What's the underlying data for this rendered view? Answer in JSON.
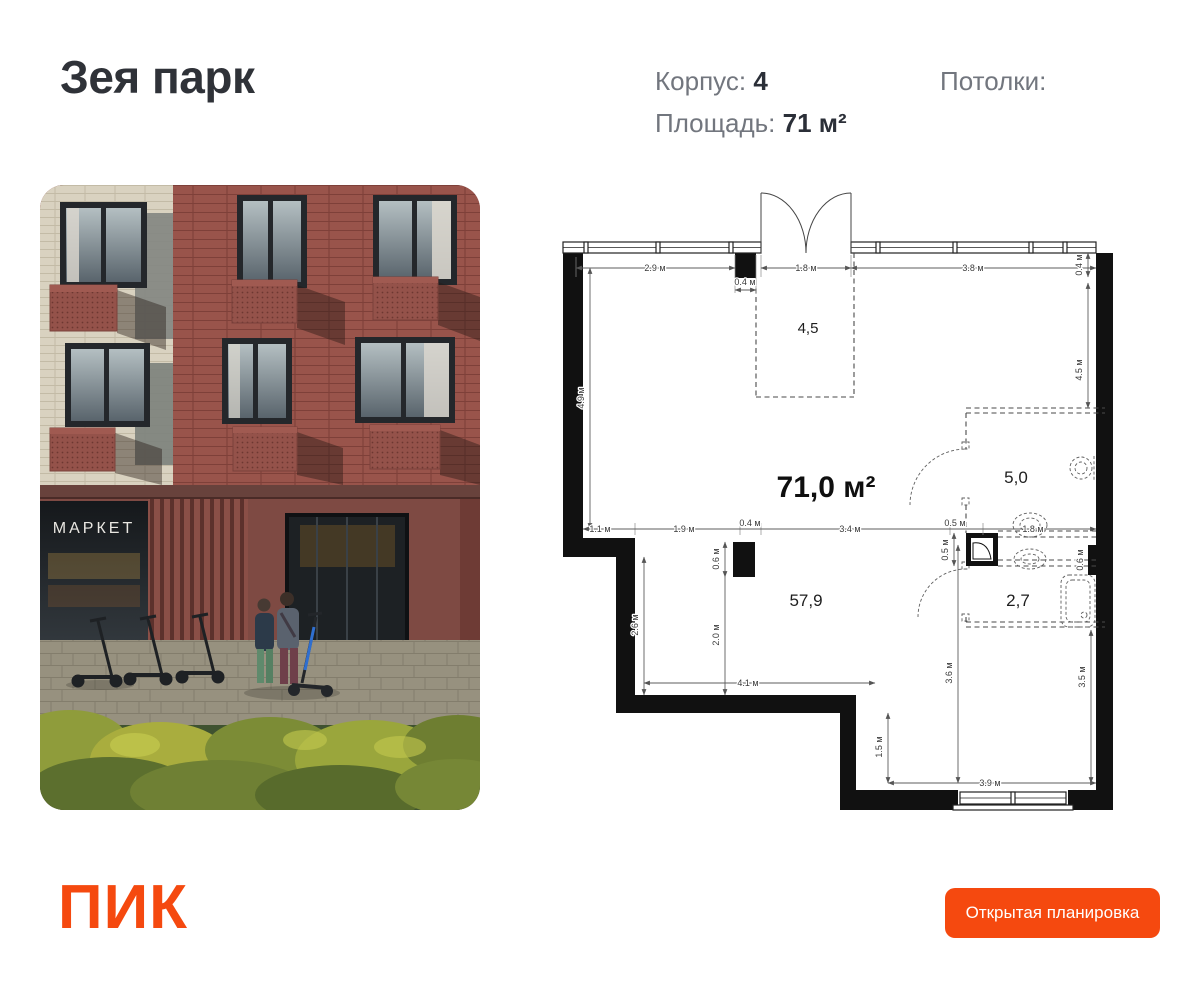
{
  "header": {
    "project_title": "Зея парк",
    "korpus": {
      "label": "Корпус:",
      "value": "4"
    },
    "area": {
      "label": "Площадь:",
      "value": "71 м²"
    },
    "ceilings": {
      "label": "Потолки:",
      "value": ""
    }
  },
  "photo": {
    "market_sign": "МАРКЕТ"
  },
  "plan": {
    "total_area": "71,0 м²",
    "rooms": [
      {
        "id": "terrace",
        "area": "4,5"
      },
      {
        "id": "living",
        "area": "57,9"
      },
      {
        "id": "wet-top",
        "area": "5,0"
      },
      {
        "id": "wet-bottom",
        "area": "2,7"
      }
    ],
    "dims": {
      "top_1": "2.9 м",
      "top_2": "0.4 м",
      "top_3": "1.8 м",
      "top_4": "3.8 м",
      "right_top": "0.4 м",
      "left_side": "4.9 м",
      "right_side": "4.5 м",
      "mid_1": "1.1 м",
      "mid_2": "1.9 м",
      "mid_3": "0.4 м",
      "mid_4": "3.4 м",
      "mid_5": "0.5 м",
      "mid_6": "1.8 м",
      "col_h": "0.6 м",
      "col_below": "2.0 м",
      "left_inner": "2.6 м",
      "bottom_inner": "4.1 м",
      "step": "1.5 м",
      "mid_v": "3.6 м",
      "right_lower": "3.5 м",
      "bottom": "3.9 м",
      "shaft_h": "0.5 м",
      "wall_nub": "0.6 м"
    }
  },
  "footer": {
    "logo_text": "ПИК",
    "button_label": "Открытая планировка"
  },
  "colors": {
    "brand_orange": "#F5490F",
    "wall": "#111111",
    "text_dark": "#2B2F38",
    "text_gray": "#72767E"
  }
}
